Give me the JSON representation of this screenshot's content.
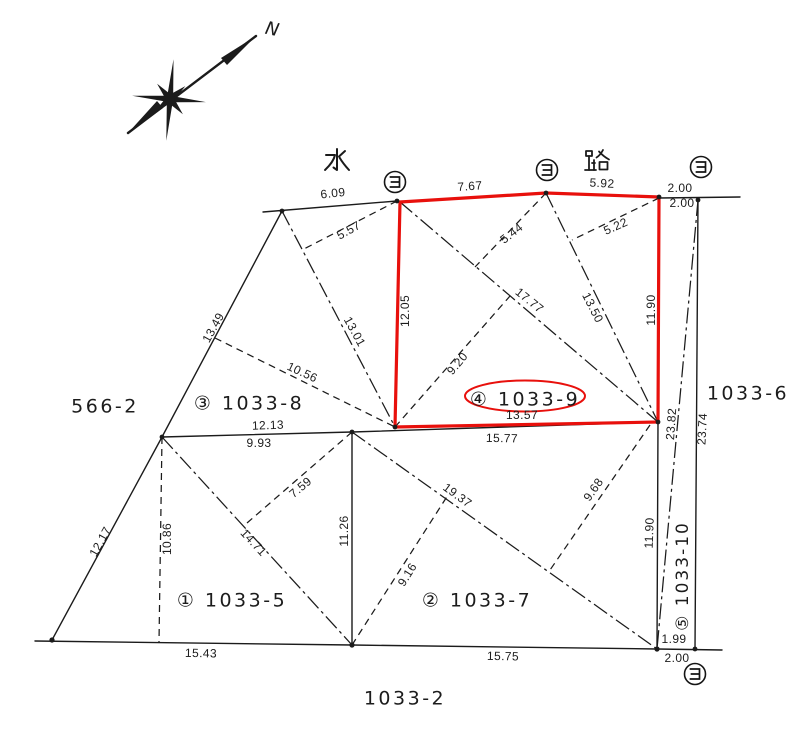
{
  "compass": {
    "north_label": "N"
  },
  "waterway": {
    "water_kanji": "水",
    "road_kanji": "路"
  },
  "boundary_markers": {
    "symbol": "ヨ"
  },
  "highlight_color": "#e8100c",
  "parcel_labels": {
    "p566_2": "566-2",
    "p1033_8": "③ 1033-8",
    "p1033_9": "④ 1033-9",
    "p1033_5": "① 1033-5",
    "p1033_7": "② 1033-7",
    "p1033_10": "⑤ 1033-10",
    "p1033_6": "1033-6",
    "p1033_2": "1033-2"
  },
  "measurements": {
    "top_edge_west": "6.09",
    "tie_557": "5.57",
    "red_top_west": "7.67",
    "red_top_east": "5.92",
    "gap_top_upper": "2.00",
    "gap_top_lower": "2.00",
    "red_left": "12.05",
    "red_right": "11.90",
    "tie_544": "5.44",
    "tie_522": "5.22",
    "diag_1777": "17.77",
    "diag_1350": "13.50",
    "tie_920": "9.20",
    "red_bottom": "13.57",
    "mid_row_east": "15.77",
    "strip_diag": "23.82",
    "strip_right": "23.74",
    "strip_left_lower": "11.90",
    "gap_bottom_upper": "1.99",
    "gap_bottom_lower": "2.00",
    "edge_1349": "13.49",
    "diag_1301": "13.01",
    "tie_1056": "10.56",
    "mid_row_west_full": "12.13",
    "mid_row_west": "9.93",
    "edge_1217": "12.17",
    "drop_1086": "10.86",
    "tie_759": "7.59",
    "diag_1471": "14.71",
    "edge_1126": "11.26",
    "tie_916": "9.16",
    "diag_1937": "19.37",
    "tie_968": "9.68",
    "bottom_west": "15.43",
    "bottom_east": "15.75"
  }
}
